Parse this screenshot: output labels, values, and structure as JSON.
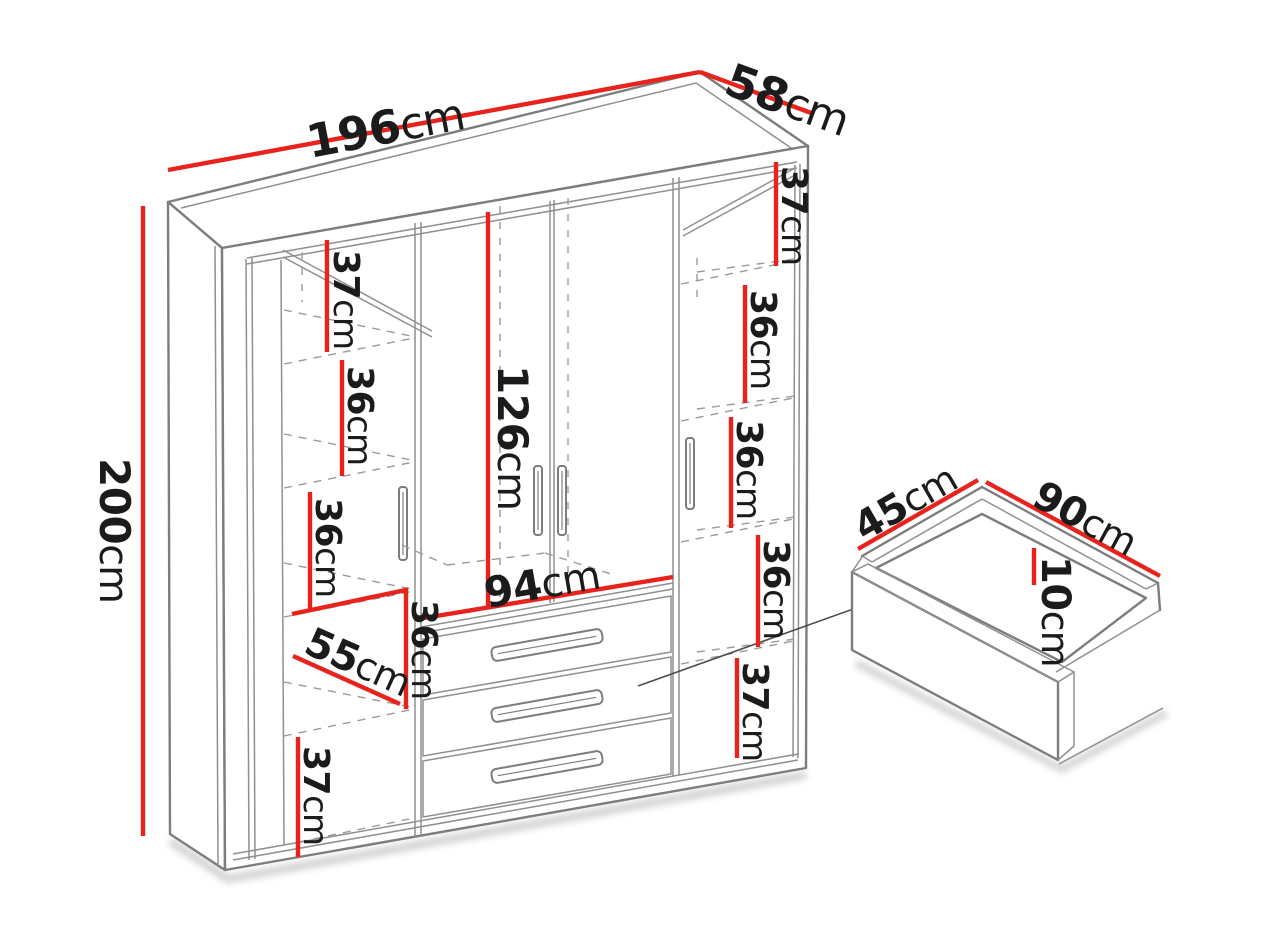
{
  "figure": {
    "kind": "wardrobe-dimension-diagram",
    "accent_color": "#e8231d",
    "line_color": "#7d7d7d",
    "unit": "cm"
  },
  "wardrobe": {
    "width": {
      "v": "196",
      "u": "cm"
    },
    "depth": {
      "v": "58",
      "u": "cm"
    },
    "height": {
      "v": "200",
      "u": "cm"
    },
    "hanging_height": {
      "v": "126",
      "u": "cm"
    },
    "drawer_section_width": {
      "v": "94",
      "u": "cm"
    },
    "left_column_width": {
      "v": "55",
      "u": "cm"
    },
    "left_shelves": [
      {
        "v": "37",
        "u": "cm"
      },
      {
        "v": "36",
        "u": "cm"
      },
      {
        "v": "36",
        "u": "cm"
      },
      {
        "v": "36",
        "u": "cm"
      },
      {
        "v": "37",
        "u": "cm"
      }
    ],
    "right_shelves": [
      {
        "v": "37",
        "u": "cm"
      },
      {
        "v": "36",
        "u": "cm"
      },
      {
        "v": "36",
        "u": "cm"
      },
      {
        "v": "36",
        "u": "cm"
      },
      {
        "v": "37",
        "u": "cm"
      }
    ]
  },
  "drawer": {
    "depth": {
      "v": "45",
      "u": "cm"
    },
    "width": {
      "v": "90",
      "u": "cm"
    },
    "height": {
      "v": "10",
      "u": "cm"
    }
  }
}
